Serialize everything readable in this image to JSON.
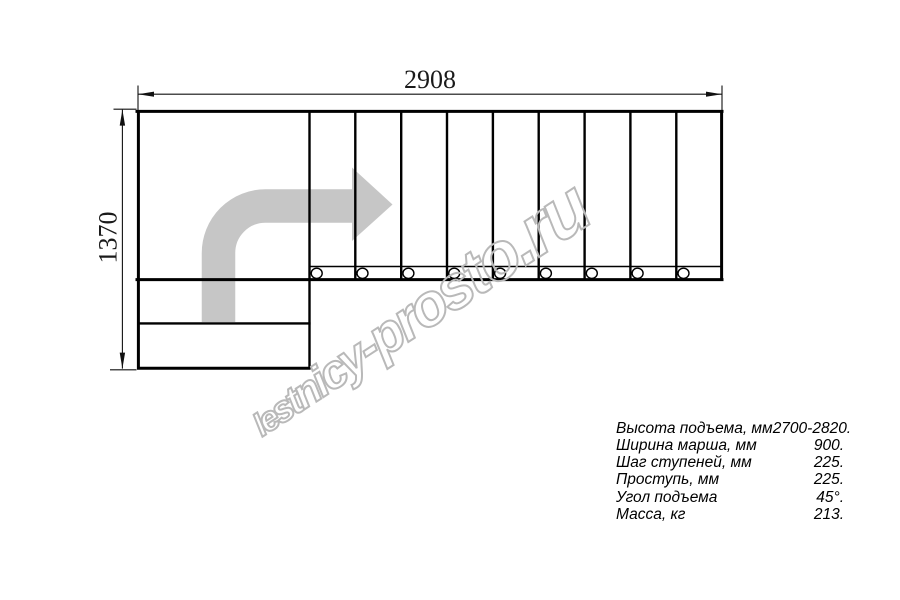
{
  "drawing": {
    "dim_width": "2908",
    "dim_height": "1370"
  },
  "specs": {
    "rows": [
      {
        "label": "Высота подъема, мм",
        "value": "2700-2820."
      },
      {
        "label": "Ширина марша, мм",
        "value": "900."
      },
      {
        "label": "Шаг ступеней, мм",
        "value": "225."
      },
      {
        "label": "Проступь, мм",
        "value": "225."
      },
      {
        "label": "Угол подъема",
        "value": "45°."
      },
      {
        "label": "Масса, кг",
        "value": "213."
      }
    ]
  },
  "watermark": {
    "text": "lestnicy-prosto.ru"
  },
  "colors": {
    "arrow": "#c6c6c6",
    "watermark": "#b9b9b9",
    "line": "#000000"
  }
}
